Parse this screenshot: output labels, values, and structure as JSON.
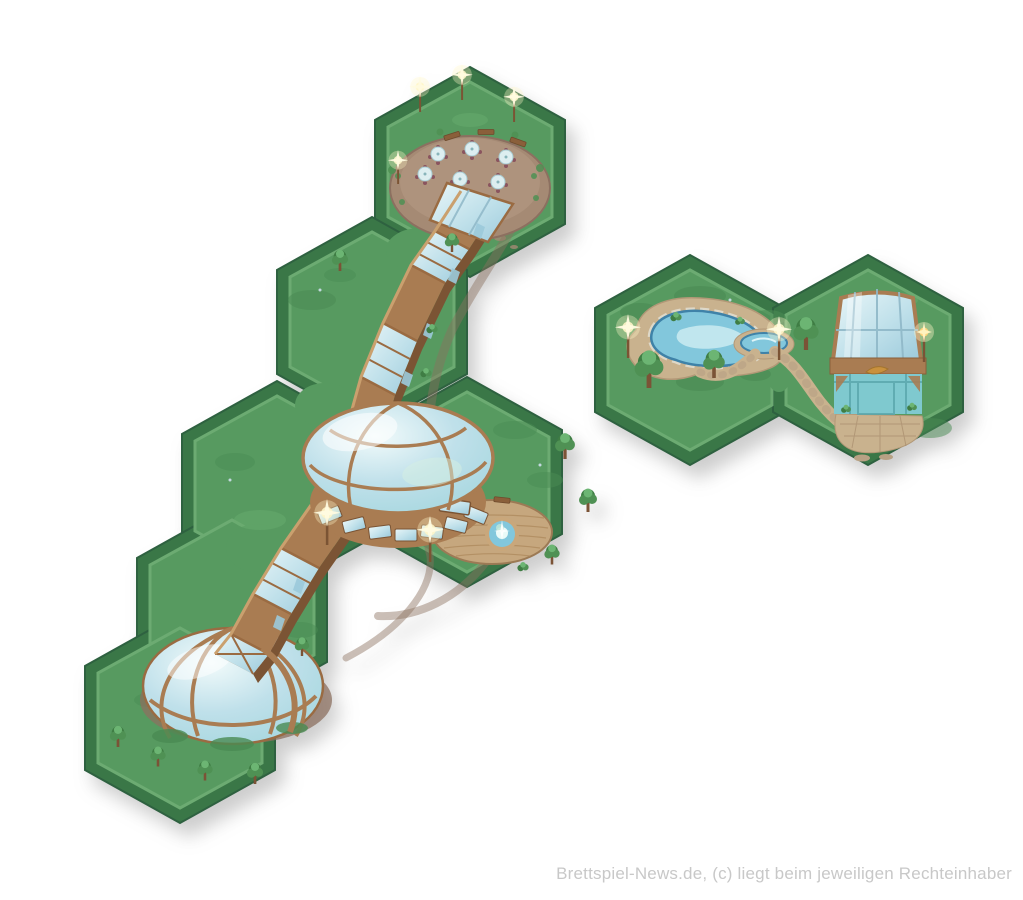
{
  "watermark": {
    "text": "Brettspiel-News.de, (c) liegt beim jeweiligen Rechteinhaber"
  },
  "illustration": {
    "type": "board-game-hex-tiles",
    "theme": "spa resort park",
    "left_group": {
      "hexes": 6,
      "features": [
        "terrace-with-parasol-tables",
        "glass-slide-walkway",
        "large-glass-dome-hall",
        "fountain-deck",
        "small-glass-dome"
      ]
    },
    "right_group": {
      "hexes": 2,
      "features": [
        "natural-pond",
        "small-pool",
        "stone-path",
        "glass-pool-house"
      ]
    }
  },
  "colors": {
    "background": "#ffffff",
    "tile_border": "#3a7747",
    "tile_border_edge": "#2e6140",
    "grass": "#579a60",
    "grass_light": "#67ab6e",
    "grass_dark": "#4a8b53",
    "grass_rim": "#6cab72",
    "dirt": "#a58a74",
    "dirt_dark": "#8c7060",
    "wood": "#a97c52",
    "wood_dark": "#7b5434",
    "wood_light": "#caa06e",
    "wood_frame": "#9a6b42",
    "glass": "#bfe0ea",
    "glass_light": "#e9f6f8",
    "glass_deep": "#9ccadb",
    "glass_teal": "#7fc9cf",
    "water": "#82c7dc",
    "water_dark": "#3f82a8",
    "sand": "#c9b28e",
    "stone": "#ded8c8",
    "deck": "#c6a77e",
    "deck_edge": "#9c7a55",
    "tree": "#4f9154",
    "tree_dark": "#3f7d44",
    "tree_light": "#6cb573",
    "trunk": "#7b5336",
    "glow": "#fff6c9",
    "umbrella": "#ddeef0",
    "chair": "#8a545e",
    "watermark": "#c8c8c8",
    "shadow": "rgba(90,90,90,0.30)"
  }
}
